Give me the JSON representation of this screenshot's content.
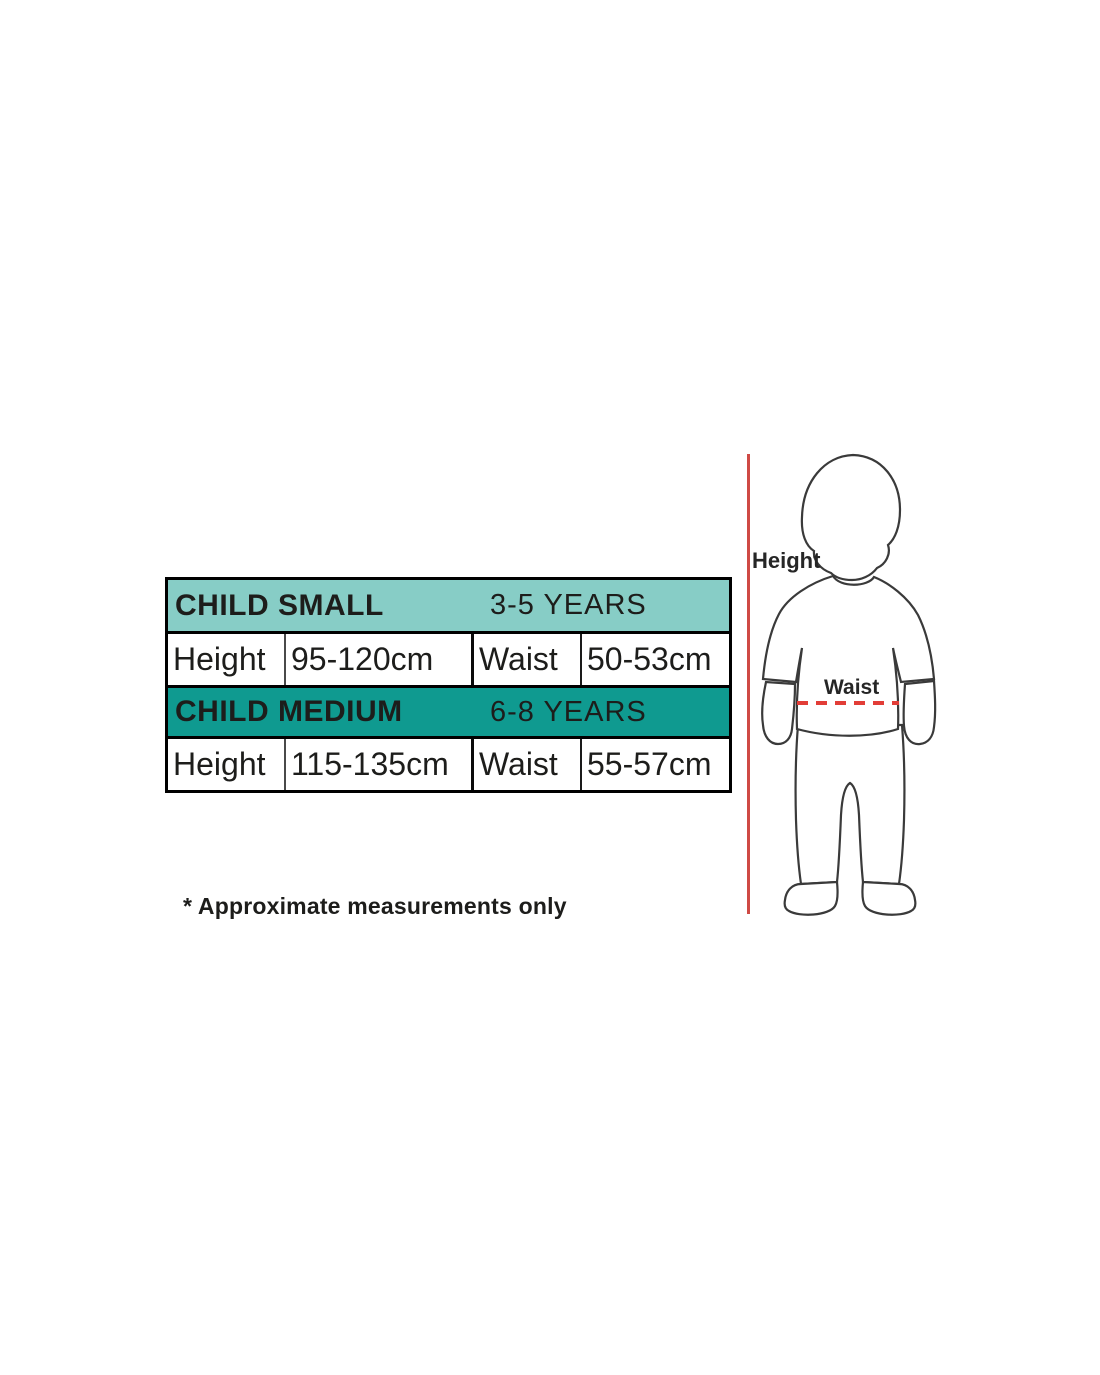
{
  "table": {
    "sections": [
      {
        "size_label": "CHILD SMALL",
        "age_label": "3-5 YEARS",
        "height_label": "Height",
        "height_value": "95-120cm",
        "waist_label": "Waist",
        "waist_value": "50-53cm"
      },
      {
        "size_label": "CHILD MEDIUM",
        "age_label": "6-8 YEARS",
        "height_label": "Height",
        "height_value": "115-135cm",
        "waist_label": "Waist",
        "waist_value": "55-57cm"
      }
    ]
  },
  "note": "* Approximate measurements only",
  "figure": {
    "height_label": "Height",
    "waist_label": "Waist"
  },
  "colors": {
    "teal_light": "#87cdc6",
    "teal_dark": "#0f9a90",
    "red_line": "#cf4a45",
    "red_dash": "#e23d37",
    "outline": "#3a3a3a",
    "text": "#1d1d1b"
  }
}
